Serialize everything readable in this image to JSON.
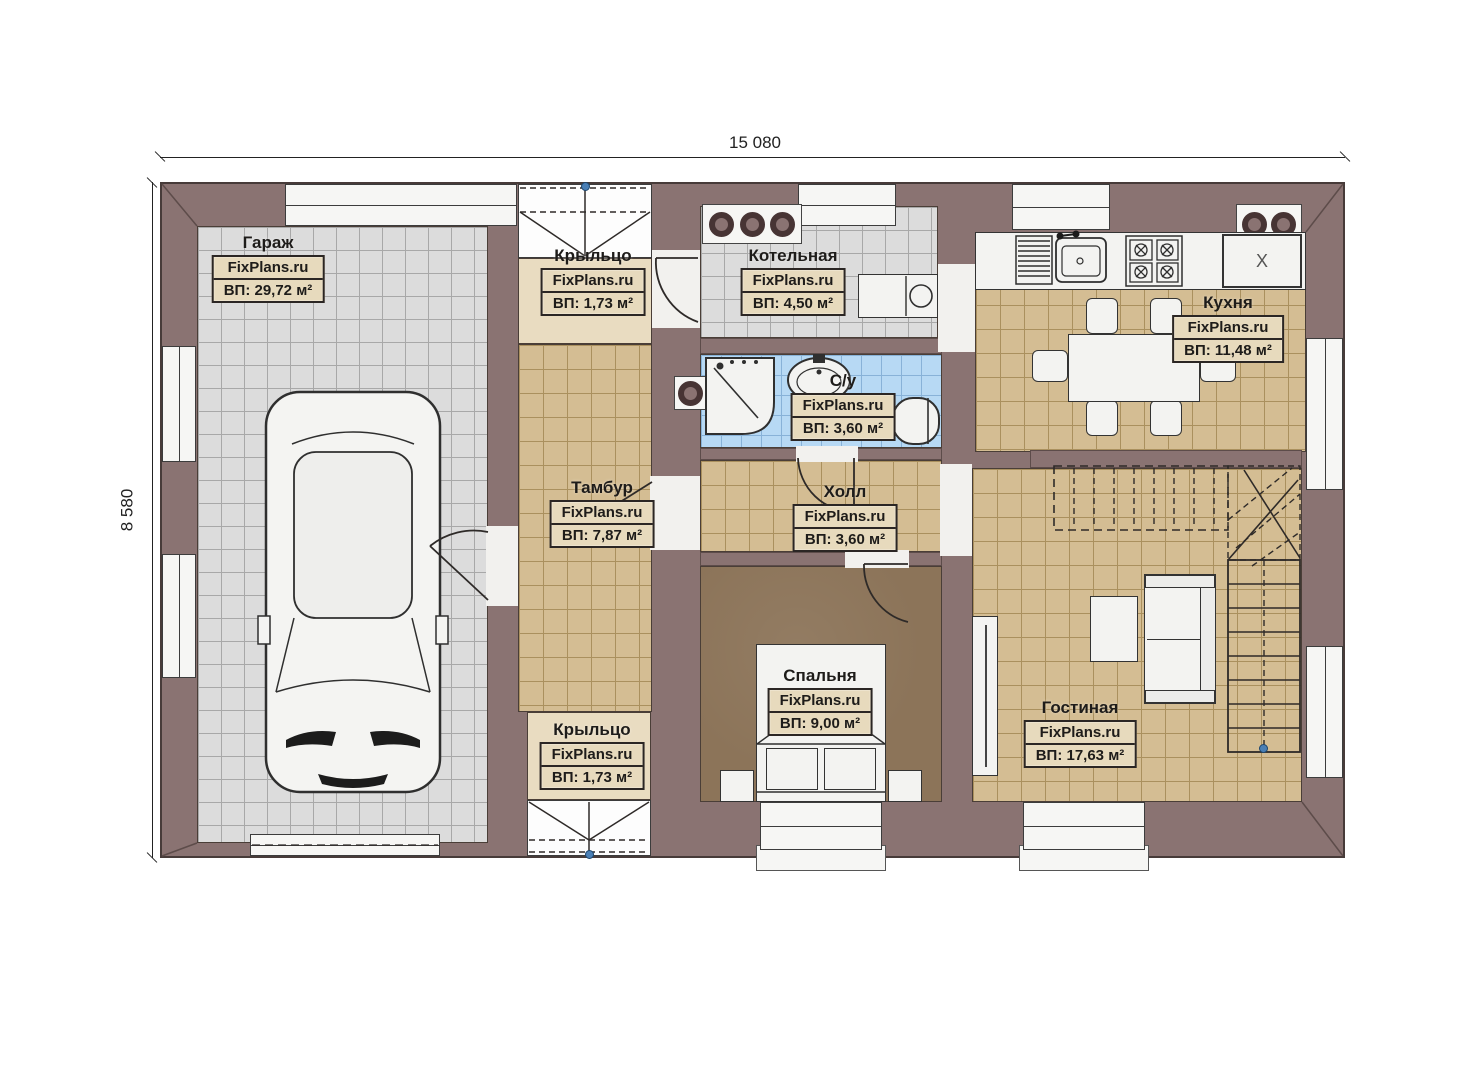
{
  "dimensions": {
    "width_mm": "15 080",
    "height_mm": "8 580"
  },
  "watermark": "FixPlans.ru",
  "rooms": [
    {
      "id": "garage",
      "name": "Гараж",
      "area": "ВП: 29,72 м²"
    },
    {
      "id": "porch-top",
      "name": "Крыльцо",
      "area": "ВП: 1,73 м²"
    },
    {
      "id": "boiler",
      "name": "Котельная",
      "area": "ВП: 4,50 м²"
    },
    {
      "id": "kitchen",
      "name": "Кухня",
      "area": "ВП: 11,48 м²"
    },
    {
      "id": "bathroom",
      "name": "С/у",
      "area": "ВП: 3,60 м²"
    },
    {
      "id": "vestibule",
      "name": "Тамбур",
      "area": "ВП: 7,87 м²"
    },
    {
      "id": "hall",
      "name": "Холл",
      "area": "ВП: 3,60 м²"
    },
    {
      "id": "bedroom",
      "name": "Спальня",
      "area": "ВП: 9,00 м²"
    },
    {
      "id": "living",
      "name": "Гостиная",
      "area": "ВП: 17,63 м²"
    },
    {
      "id": "porch-bottom",
      "name": "Крыльцо",
      "area": "ВП: 1,73 м²"
    }
  ],
  "fixtures": {
    "fridge_mark": "X"
  },
  "colors": {
    "wall": "#8a7372",
    "tile_grey": "#dcdcdc",
    "tile_tan": "#d4bd93",
    "tile_blue": "#b7d9f4",
    "floor_bedroom": "#8c7459",
    "floor_porch": "#e9dcc1",
    "marker_blue": "#4a7fb5"
  }
}
